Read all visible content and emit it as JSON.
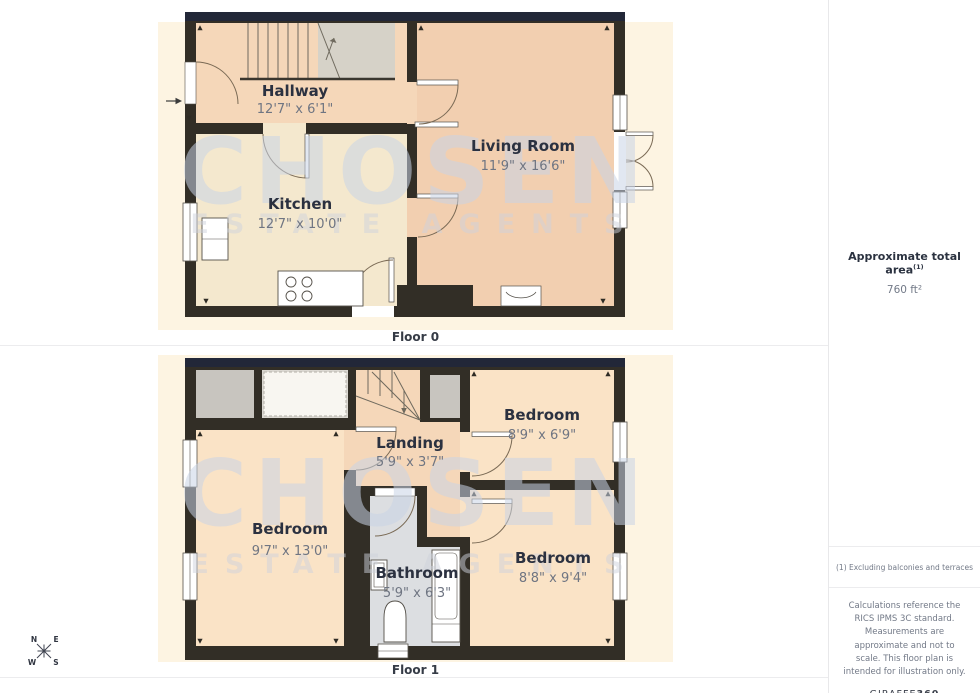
{
  "floors": [
    {
      "label": "Floor 0",
      "rooms": [
        {
          "name": "Hallway",
          "dims": "12'7\" x 6'1\""
        },
        {
          "name": "Kitchen",
          "dims": "12'7\" x 10'0\""
        },
        {
          "name": "Living Room",
          "dims": "11'9\" x 16'6\""
        }
      ]
    },
    {
      "label": "Floor 1",
      "rooms": [
        {
          "name": "Bedroom",
          "dims": "8'9\" x 6'9\""
        },
        {
          "name": "Landing",
          "dims": "5'9\" x 3'7\""
        },
        {
          "name": "Bedroom",
          "dims": "9'7\" x 13'0\""
        },
        {
          "name": "Bathroom",
          "dims": "5'9\" x 6'3\""
        },
        {
          "name": "Bedroom",
          "dims": "8'8\" x 9'4\""
        }
      ]
    }
  ],
  "watermark": {
    "line1": "CHOSEN",
    "line2": "ESTATE AGENTS"
  },
  "sidebar": {
    "total_area_label": "Approximate total area",
    "total_area_sup": "(1)",
    "total_area_value": "760 ft²",
    "footnote": "(1) Excluding balconies and terraces",
    "disclaimer": "Calculations reference the RICS IPMS 3C standard. Measurements are approximate and not to scale. This floor plan is intended for illustration only.",
    "brand_name": "GIRAFFE",
    "brand_number": "360"
  },
  "compass": {
    "north": "N",
    "east": "E",
    "south": "S",
    "west": "W"
  },
  "colors": {
    "wall": "#322e26",
    "wall_top_band": "#222738",
    "hallway_floor": "#f5d7b9",
    "living_floor": "#f2cfb0",
    "kitchen_floor": "#f4e8ce",
    "bedroom_floor": "#fae3c6",
    "bathroom_floor": "#dcdee1",
    "closet_gray": "#c8c5bf",
    "stair_upper_gray": "#d6d2c8",
    "background_panel": "#fdf4e2",
    "watermark": "#c9d3e5"
  }
}
